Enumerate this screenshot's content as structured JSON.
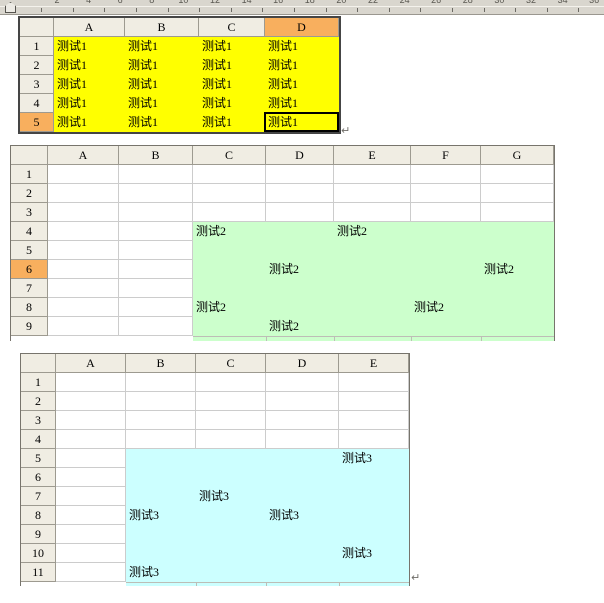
{
  "ruler": {
    "numbers": [
      2,
      4,
      6,
      8,
      10,
      12,
      14,
      16,
      18,
      20,
      22,
      24,
      26,
      28,
      30,
      32,
      34,
      36,
      38,
      40
    ]
  },
  "colors": {
    "header_bg": "#F0EDE3",
    "header_selected": "#F8AF5E",
    "grid_line": "#CCCCCC",
    "fill_yellow": "#FFFF00",
    "fill_green": "#CCFFCC",
    "fill_cyan": "#CCFFFF"
  },
  "sheets": [
    {
      "id": "sheet-1",
      "columns": [
        "A",
        "B",
        "C",
        "D"
      ],
      "row_count": 5,
      "row_labels": [
        "1",
        "2",
        "3",
        "4",
        "5"
      ],
      "selected_column": "D",
      "selected_row": "5",
      "active_cell": "D5",
      "fill_color": "#FFFF00",
      "fill_range": "A1:D5",
      "cells": [
        {
          "cell": "A1",
          "text": "测试1"
        },
        {
          "cell": "B1",
          "text": "测试1"
        },
        {
          "cell": "C1",
          "text": "测试1"
        },
        {
          "cell": "D1",
          "text": "测试1"
        },
        {
          "cell": "A2",
          "text": "测试1"
        },
        {
          "cell": "B2",
          "text": "测试1"
        },
        {
          "cell": "C2",
          "text": "测试1"
        },
        {
          "cell": "D2",
          "text": "测试1"
        },
        {
          "cell": "A3",
          "text": "测试1"
        },
        {
          "cell": "B3",
          "text": "测试1"
        },
        {
          "cell": "C3",
          "text": "测试1"
        },
        {
          "cell": "D3",
          "text": "测试1"
        },
        {
          "cell": "A4",
          "text": "测试1"
        },
        {
          "cell": "B4",
          "text": "测试1"
        },
        {
          "cell": "C4",
          "text": "测试1"
        },
        {
          "cell": "D4",
          "text": "测试1"
        },
        {
          "cell": "A5",
          "text": "测试1"
        },
        {
          "cell": "B5",
          "text": "测试1"
        },
        {
          "cell": "C5",
          "text": "测试1"
        },
        {
          "cell": "D5",
          "text": "测试1"
        }
      ],
      "cursor_mark": "↵"
    },
    {
      "id": "sheet-2",
      "columns": [
        "A",
        "B",
        "C",
        "D",
        "E",
        "F",
        "G"
      ],
      "row_count": 9,
      "row_labels": [
        "1",
        "2",
        "3",
        "4",
        "5",
        "6",
        "7",
        "8",
        "9"
      ],
      "selected_column": "",
      "selected_row": "6",
      "active_cell": "",
      "fill_color": "#CCFFCC",
      "fill_range": "C4:G9",
      "cells": [
        {
          "cell": "C4",
          "text": "测试2"
        },
        {
          "cell": "E4",
          "text": "测试2"
        },
        {
          "cell": "D6",
          "text": "测试2"
        },
        {
          "cell": "G6",
          "text": "测试2"
        },
        {
          "cell": "C8",
          "text": "测试2"
        },
        {
          "cell": "F8",
          "text": "测试2"
        },
        {
          "cell": "D9",
          "text": "测试2"
        }
      ],
      "cursor_mark": ""
    },
    {
      "id": "sheet-3",
      "columns": [
        "A",
        "B",
        "C",
        "D",
        "E"
      ],
      "row_count": 11,
      "row_labels": [
        "1",
        "2",
        "3",
        "4",
        "5",
        "6",
        "7",
        "8",
        "9",
        "10",
        "11"
      ],
      "selected_column": "",
      "selected_row": "",
      "active_cell": "",
      "fill_color": "#CCFFFF",
      "fill_range": "B5:E11",
      "cells": [
        {
          "cell": "E5",
          "text": "测试3"
        },
        {
          "cell": "C7",
          "text": "测试3"
        },
        {
          "cell": "B8",
          "text": "测试3"
        },
        {
          "cell": "D8",
          "text": "测试3"
        },
        {
          "cell": "E10",
          "text": "测试3"
        },
        {
          "cell": "B11",
          "text": "测试3"
        }
      ],
      "cursor_mark": "↵"
    }
  ]
}
